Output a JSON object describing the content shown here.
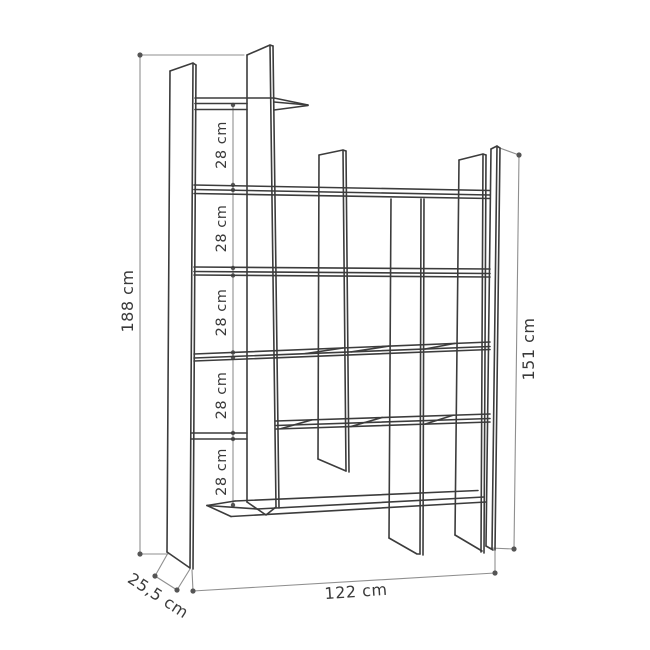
{
  "drawing": {
    "subject": "bookcase-dimension-diagram",
    "dimensions": {
      "total_height": "188 cm",
      "right_height": "151 cm",
      "width": "122 cm",
      "depth": "25,5 cm",
      "shelf_spacing": [
        "28 cm",
        "28 cm",
        "28 cm",
        "28 cm",
        "28 cm"
      ]
    },
    "colors": {
      "outline": "#3c3c3c",
      "dimension_lines": "#8f8f8f",
      "dimension_dots": "#555555",
      "text": "#3a3a3a",
      "background": "#ffffff"
    }
  }
}
